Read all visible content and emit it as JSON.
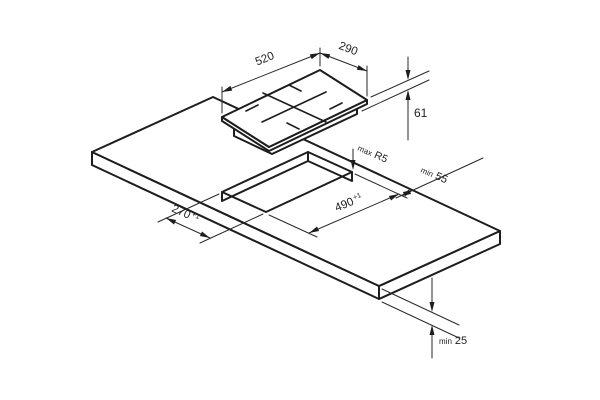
{
  "figure": {
    "title": "Hob installation diagram",
    "background": "#ffffff",
    "line_color": "#1d1d1d",
    "text_color": "#1e1e1e"
  },
  "dims": {
    "hob_width": {
      "value": "520"
    },
    "hob_depth": {
      "value": "290"
    },
    "hob_height": {
      "value": "61"
    },
    "corner_radius": {
      "prefix": "max",
      "value": "R5"
    },
    "rear_clearance": {
      "prefix": "min",
      "value": "55"
    },
    "cutout_length": {
      "value": "490",
      "tol": "+1"
    },
    "cutout_width": {
      "value": "270",
      "tol": "+1"
    },
    "worktop_thickness": {
      "prefix": "min",
      "value": "25"
    }
  }
}
